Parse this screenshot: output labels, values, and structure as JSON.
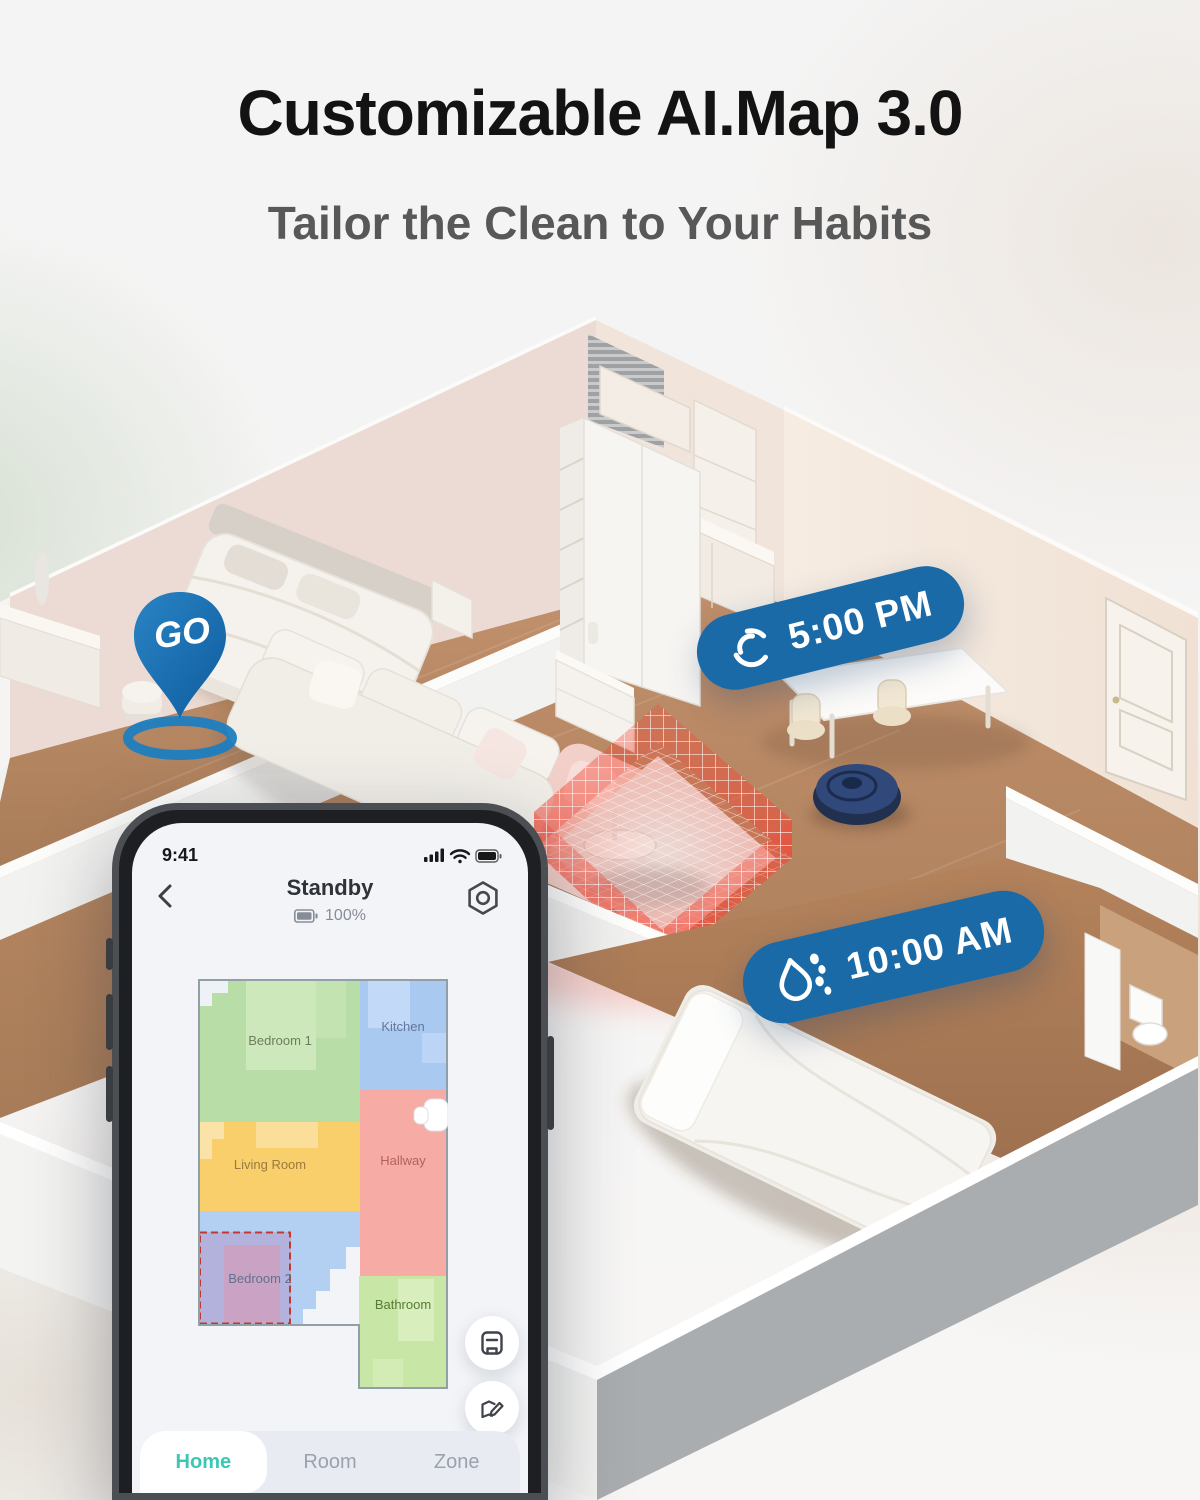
{
  "header": {
    "title": "Customizable AI.Map 3.0",
    "subtitle": "Tailor the Clean to Your Habits"
  },
  "scene": {
    "go_pin": {
      "label": "GO",
      "color": "#14649f"
    },
    "badges": [
      {
        "time": "5:00 PM",
        "icon": "vacuum-spin-icon"
      },
      {
        "time": "10:00 AM",
        "icon": "water-drop-icon"
      }
    ],
    "accent_blue": "#1b6aa8",
    "no_go_zone_color": "#f04a38"
  },
  "phone": {
    "status_bar": {
      "time": "9:41",
      "icons": [
        "signal-icon",
        "wifi-icon",
        "battery-icon"
      ]
    },
    "header": {
      "title": "Standby",
      "battery_percent": "100%",
      "back_icon": "back-chevron-icon",
      "settings_icon": "settings-gear-icon"
    },
    "map": {
      "rooms": [
        {
          "name": "Bedroom 1",
          "fill": "#b9dda6",
          "label_color": "#6e7d5c"
        },
        {
          "name": "Kitchen",
          "fill": "#a9c9f1",
          "label_color": "#64789a"
        },
        {
          "name": "Living Room",
          "fill": "#f8cf6b",
          "label_color": "#9a7b3e"
        },
        {
          "name": "Hallway",
          "fill": "#f6aca4",
          "label_color": "#b2625c"
        },
        {
          "name": "Bedroom 2",
          "fill": "#b3cff2",
          "label_color": "#5f7291"
        },
        {
          "name": "Bathroom",
          "fill": "#c8e6a5",
          "label_color": "#567b36"
        }
      ],
      "zone_border_color": "#c0392f",
      "dock_icon": "robot-dock-icon"
    },
    "floating_buttons": [
      {
        "icon": "save-map-icon"
      },
      {
        "icon": "edit-map-icon"
      }
    ],
    "tabs": [
      {
        "label": "Home",
        "active": true
      },
      {
        "label": "Room",
        "active": false
      },
      {
        "label": "Zone",
        "active": false
      }
    ],
    "active_tab_color": "#3cc7b3"
  }
}
